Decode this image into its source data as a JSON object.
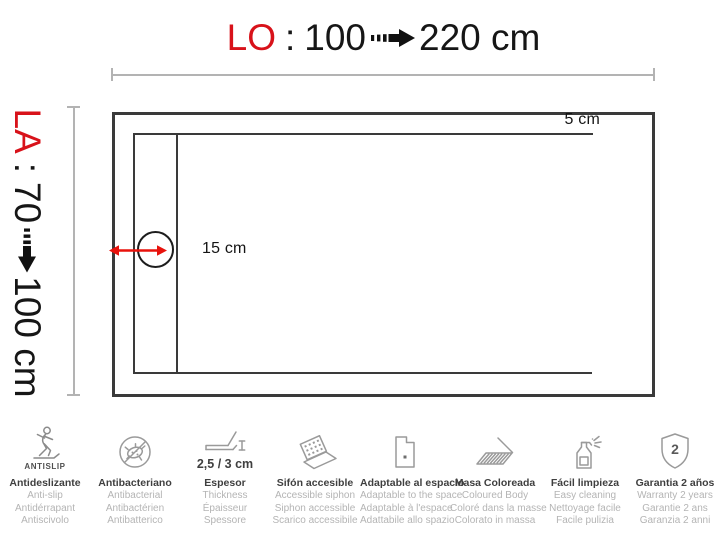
{
  "title": {
    "prefix": "LO",
    "sep": ":",
    "from": "100",
    "to": "220 cm"
  },
  "side": {
    "prefix": "LA",
    "sep": ":",
    "from": "70",
    "to": "100 cm"
  },
  "callouts": {
    "border": "5 cm",
    "drain": "15 cm"
  },
  "colors": {
    "accent_red": "#d8121a",
    "arrow_red": "#e8120c",
    "line_dark": "#3a3a3a",
    "measure_gray": "#b3b3b3",
    "icon_gray": "#9a9a9a",
    "text_dark": "#3f3f3f",
    "text_gray": "#b4b4b4"
  },
  "features": [
    {
      "icon": "antislip-icon",
      "caption": "ANTISLIP",
      "lines": [
        "Antideslizante",
        "Anti-slip",
        "Antidérrapant",
        "Antiscivolo"
      ]
    },
    {
      "icon": "antibacterial-icon",
      "lines": [
        "Antibacteriano",
        "Antibacterial",
        "Antibactérien",
        "Antibatterico"
      ]
    },
    {
      "icon": "thickness-icon",
      "caption": "2,5 / 3 cm",
      "lines": [
        "Espesor",
        "Thickness",
        "Épaisseur",
        "Spessore"
      ]
    },
    {
      "icon": "siphon-icon",
      "lines": [
        "Sifón accesible",
        "Accessible siphon",
        "Siphon accessible",
        "Scarico accessibile"
      ]
    },
    {
      "icon": "adaptable-icon",
      "lines": [
        "Adaptable al espacio",
        "Adaptable to the space",
        "Adaptable à l'espace",
        "Adattabile allo spazio"
      ]
    },
    {
      "icon": "colored-body-icon",
      "lines": [
        "Masa Coloreada",
        "Coloured Body",
        "Coloré dans la masse",
        "Colorato in massa"
      ]
    },
    {
      "icon": "easy-cleaning-icon",
      "lines": [
        "Fácil limpieza",
        "Easy cleaning",
        "Nettoyage facile",
        "Facile pulizia"
      ]
    },
    {
      "icon": "warranty-icon",
      "badge": "2",
      "lines": [
        "Garantia 2 años",
        "Warranty 2 years",
        "Garantie 2 ans",
        "Garanzia 2 anni"
      ]
    }
  ]
}
